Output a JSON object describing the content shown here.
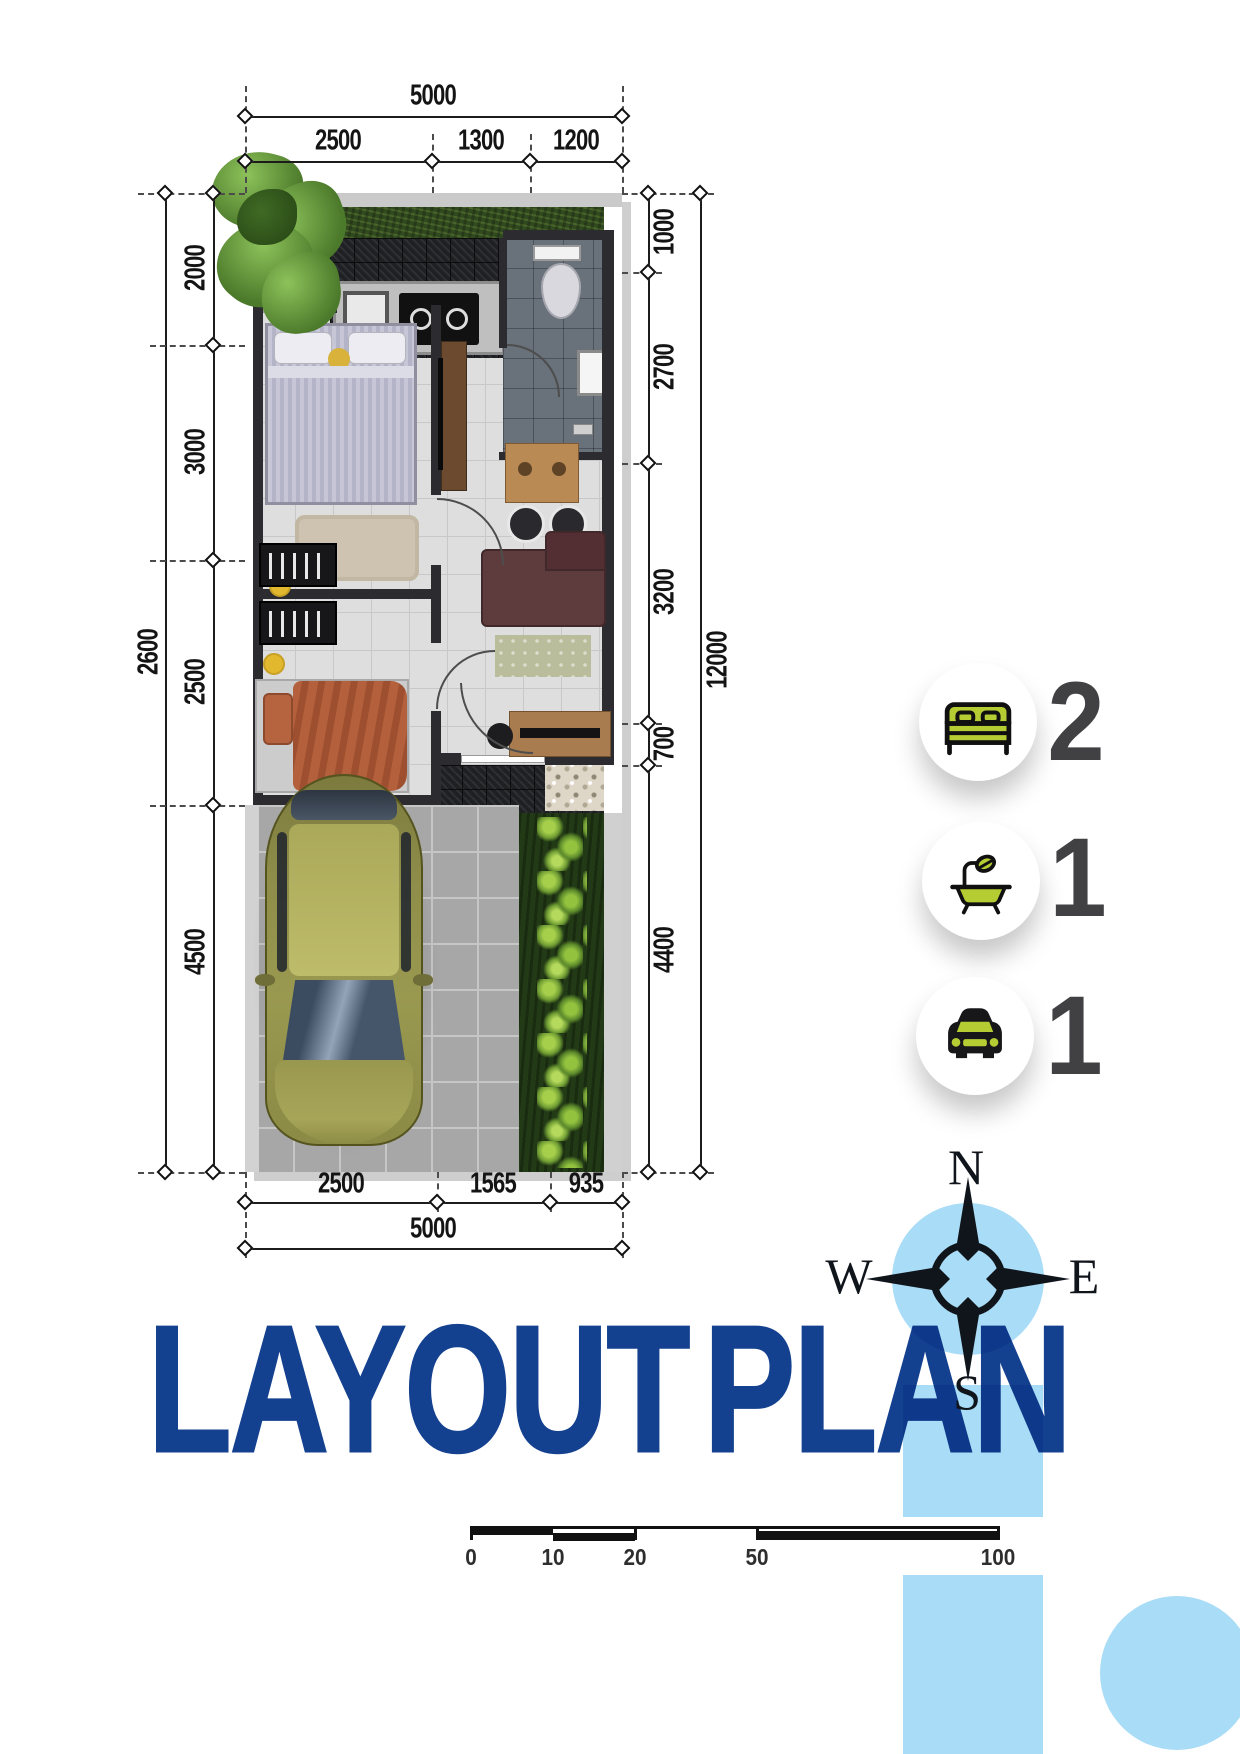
{
  "title": {
    "word1": "LAYOUT",
    "word2": "PLAN"
  },
  "compass": {
    "north": "N",
    "east": "E",
    "south": "S",
    "west": "W"
  },
  "legend": {
    "bedrooms": {
      "icon": "bed-icon",
      "count": "2"
    },
    "bathrooms": {
      "icon": "bath-icon",
      "count": "1"
    },
    "carports": {
      "icon": "car-icon",
      "count": "1"
    }
  },
  "scale_bar": {
    "labels": [
      "0",
      "10",
      "20",
      "50",
      "100"
    ]
  },
  "plan": {
    "top": {
      "total": "5000",
      "segments": [
        "2500",
        "1300",
        "1200"
      ]
    },
    "left": {
      "outer": "2600",
      "segments": [
        "2000",
        "3000",
        "2500",
        "4500"
      ]
    },
    "right": {
      "outer": "12000",
      "segments": [
        "1000",
        "2700",
        "3200",
        "700",
        "4400"
      ]
    },
    "bottom": {
      "total": "5000",
      "segments": [
        "2500",
        "1565",
        "935"
      ]
    }
  },
  "colors": {
    "title_navy": "#14418f",
    "light_blue": "#a9dcf6",
    "icon_green": "#b5cc33",
    "count_gray": "#414144"
  }
}
